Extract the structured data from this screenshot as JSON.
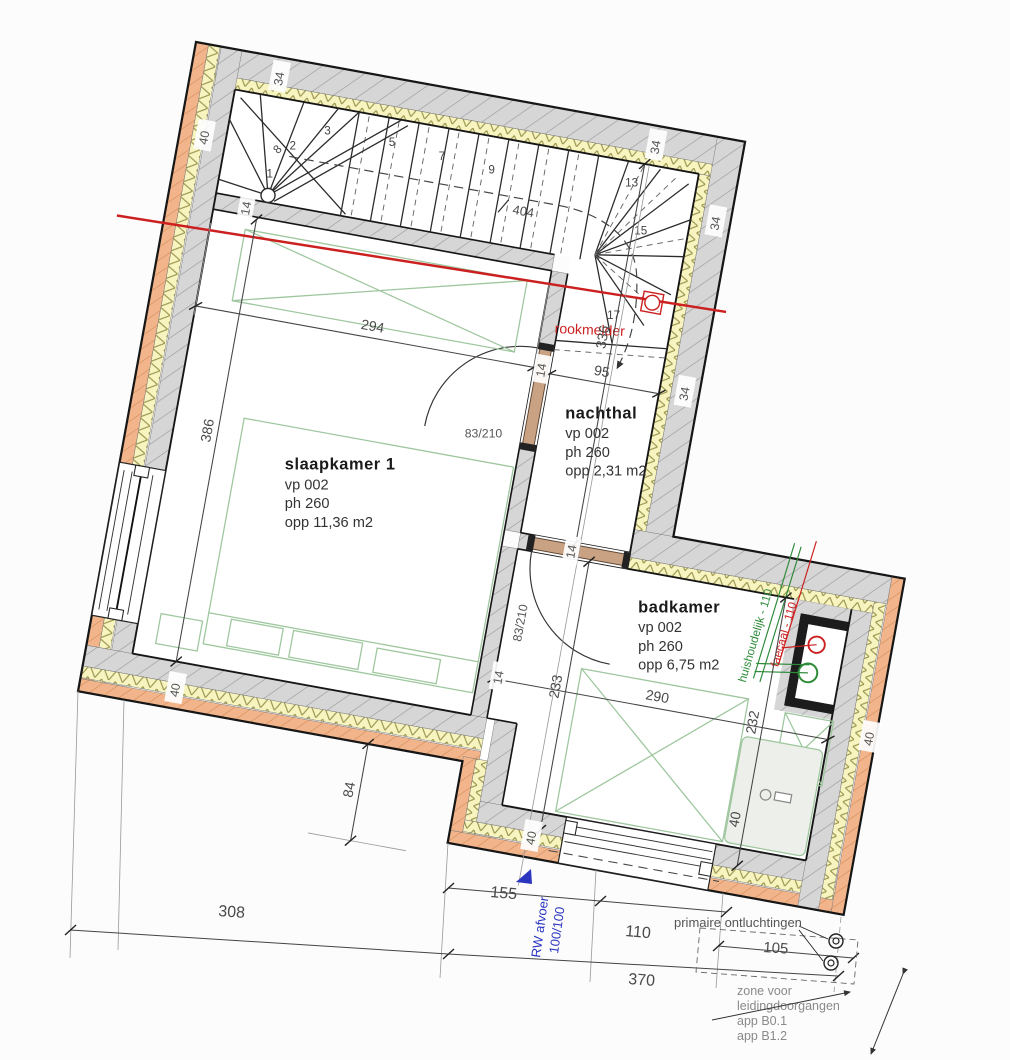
{
  "rooms": {
    "slaapkamer": {
      "title": "slaapkamer 1",
      "vp": "vp 002",
      "ph": "ph 260",
      "opp": "opp 11,36 m2"
    },
    "nachthal": {
      "title": "nachthal",
      "vp": "vp 002",
      "ph": "ph 260",
      "opp": "opp 2,31 m2"
    },
    "badkamer": {
      "title": "badkamer",
      "vp": "vp 002",
      "ph": "ph 260",
      "opp": "opp 6,75 m2"
    }
  },
  "dims": {
    "d294": "294",
    "d386": "386",
    "d95": "95",
    "d336": "336",
    "d404": "404",
    "d290": "290",
    "d233": "233",
    "d232": "232",
    "d84": "84",
    "d308": "308",
    "d155": "155",
    "d110": "110",
    "d370": "370",
    "d105": "105"
  },
  "walls": {
    "t40": "40",
    "t34": "34",
    "t14": "14"
  },
  "doors": {
    "slaap": "83/210",
    "bad": "83/210"
  },
  "stairs": {
    "treads": [
      "1",
      "2",
      "3",
      "5",
      "7",
      "9",
      "13",
      "15",
      "17"
    ],
    "break_label": "8"
  },
  "annotations": {
    "rookmelder": "rookmelder",
    "rw1": "RW afvoer",
    "rw2": "100/100",
    "huishoudelijk": "huishoudelijk - 110",
    "faecaal": "faecaal - 110",
    "primaire": "primaire ontluchtingen",
    "zone1": "zone voor",
    "zone2": "leidingdoorgangen",
    "zone3": "app B0.1",
    "zone4": "app B1.2"
  },
  "colors": {
    "section_red": "#cc1f1f",
    "pipe_green": "#2e8b3a",
    "rw_blue": "#2a35c0",
    "brick_orange": "#f0b287",
    "insulation_yellow": "#f8f4c0",
    "wall_gray": "#d6d6d6",
    "furniture_green": "#9fc79f"
  }
}
